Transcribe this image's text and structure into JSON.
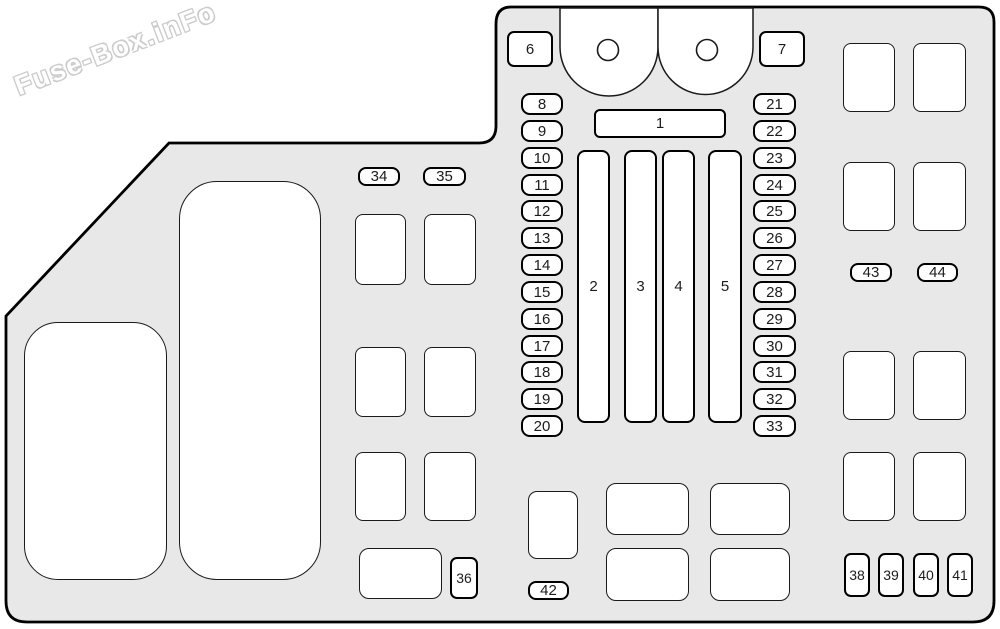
{
  "watermark": {
    "text": "Fuse-Box.inFo"
  },
  "colors": {
    "panel_fill": "#e8e8e8",
    "outline": "#000000",
    "box_fill": "#ffffff",
    "thin_line": "#1a1a1a",
    "label_text": "#1c1c1c"
  },
  "panel": {
    "description": "fuse-box-diagram",
    "numbered_boxes": [
      {
        "label": "6",
        "x": 507,
        "y": 31,
        "w": 46,
        "h": 36,
        "r": 7
      },
      {
        "label": "7",
        "x": 759,
        "y": 31,
        "w": 46,
        "h": 36,
        "r": 7
      },
      {
        "label": "1",
        "x": 594,
        "y": 109,
        "w": 132,
        "h": 29,
        "r": 6
      },
      {
        "label": "2",
        "x": 577,
        "y": 150,
        "w": 33,
        "h": 273,
        "r": 8
      },
      {
        "label": "3",
        "x": 624,
        "y": 150,
        "w": 33,
        "h": 273,
        "r": 8
      },
      {
        "label": "4",
        "x": 662,
        "y": 150,
        "w": 33,
        "h": 273,
        "r": 8
      },
      {
        "label": "5",
        "x": 708,
        "y": 150,
        "w": 34,
        "h": 273,
        "r": 8
      },
      {
        "label": "8",
        "x": 521,
        "y": 93,
        "w": 42,
        "h": 22,
        "r": 9
      },
      {
        "label": "9",
        "x": 521,
        "y": 120,
        "w": 42,
        "h": 22,
        "r": 9
      },
      {
        "label": "10",
        "x": 521,
        "y": 147,
        "w": 42,
        "h": 22,
        "r": 9
      },
      {
        "label": "11",
        "x": 521,
        "y": 174,
        "w": 42,
        "h": 22,
        "r": 9
      },
      {
        "label": "12",
        "x": 521,
        "y": 200,
        "w": 42,
        "h": 22,
        "r": 9
      },
      {
        "label": "13",
        "x": 521,
        "y": 227,
        "w": 42,
        "h": 22,
        "r": 9
      },
      {
        "label": "14",
        "x": 521,
        "y": 254,
        "w": 42,
        "h": 22,
        "r": 9
      },
      {
        "label": "15",
        "x": 521,
        "y": 281,
        "w": 42,
        "h": 22,
        "r": 9
      },
      {
        "label": "16",
        "x": 521,
        "y": 308,
        "w": 42,
        "h": 22,
        "r": 9
      },
      {
        "label": "17",
        "x": 521,
        "y": 335,
        "w": 42,
        "h": 22,
        "r": 9
      },
      {
        "label": "18",
        "x": 521,
        "y": 361,
        "w": 42,
        "h": 22,
        "r": 9
      },
      {
        "label": "19",
        "x": 521,
        "y": 388,
        "w": 42,
        "h": 22,
        "r": 9
      },
      {
        "label": "20",
        "x": 521,
        "y": 415,
        "w": 42,
        "h": 22,
        "r": 9
      },
      {
        "label": "21",
        "x": 753,
        "y": 93,
        "w": 43,
        "h": 22,
        "r": 9
      },
      {
        "label": "22",
        "x": 753,
        "y": 120,
        "w": 43,
        "h": 22,
        "r": 9
      },
      {
        "label": "23",
        "x": 753,
        "y": 147,
        "w": 43,
        "h": 22,
        "r": 9
      },
      {
        "label": "24",
        "x": 753,
        "y": 174,
        "w": 43,
        "h": 22,
        "r": 9
      },
      {
        "label": "25",
        "x": 753,
        "y": 200,
        "w": 43,
        "h": 22,
        "r": 9
      },
      {
        "label": "26",
        "x": 753,
        "y": 227,
        "w": 43,
        "h": 22,
        "r": 9
      },
      {
        "label": "27",
        "x": 753,
        "y": 254,
        "w": 43,
        "h": 22,
        "r": 9
      },
      {
        "label": "28",
        "x": 753,
        "y": 281,
        "w": 43,
        "h": 22,
        "r": 9
      },
      {
        "label": "29",
        "x": 753,
        "y": 308,
        "w": 43,
        "h": 22,
        "r": 9
      },
      {
        "label": "30",
        "x": 753,
        "y": 335,
        "w": 43,
        "h": 22,
        "r": 9
      },
      {
        "label": "31",
        "x": 753,
        "y": 361,
        "w": 43,
        "h": 22,
        "r": 9
      },
      {
        "label": "32",
        "x": 753,
        "y": 388,
        "w": 43,
        "h": 22,
        "r": 9
      },
      {
        "label": "33",
        "x": 753,
        "y": 415,
        "w": 43,
        "h": 22,
        "r": 9
      },
      {
        "label": "34",
        "x": 358,
        "y": 167,
        "w": 42,
        "h": 19,
        "r": 8
      },
      {
        "label": "35",
        "x": 423,
        "y": 167,
        "w": 43,
        "h": 19,
        "r": 8
      },
      {
        "label": "36",
        "x": 450,
        "y": 557,
        "w": 28,
        "h": 42,
        "r": 7,
        "fs": 14
      },
      {
        "label": "38",
        "x": 844,
        "y": 553,
        "w": 26,
        "h": 44,
        "r": 7,
        "fs": 14
      },
      {
        "label": "39",
        "x": 878,
        "y": 553,
        "w": 26,
        "h": 44,
        "r": 7,
        "fs": 14
      },
      {
        "label": "40",
        "x": 913,
        "y": 553,
        "w": 26,
        "h": 44,
        "r": 7,
        "fs": 14
      },
      {
        "label": "41",
        "x": 947,
        "y": 553,
        "w": 26,
        "h": 44,
        "r": 7,
        "fs": 14
      },
      {
        "label": "42",
        "x": 528,
        "y": 581,
        "w": 41,
        "h": 19,
        "r": 8
      },
      {
        "label": "43",
        "x": 850,
        "y": 263,
        "w": 42,
        "h": 19,
        "r": 8
      },
      {
        "label": "44",
        "x": 917,
        "y": 263,
        "w": 41,
        "h": 19,
        "r": 8
      }
    ],
    "plain_boxes": [
      {
        "name": "cover-left",
        "x": 24,
        "y": 322,
        "w": 143,
        "h": 258,
        "r": 34
      },
      {
        "name": "cover-tall",
        "x": 179,
        "y": 181,
        "w": 142,
        "h": 399,
        "r": 38
      },
      {
        "name": "relay-block",
        "x": 355,
        "y": 214,
        "w": 51,
        "h": 71,
        "r": 8
      },
      {
        "name": "relay-block",
        "x": 424,
        "y": 214,
        "w": 52,
        "h": 71,
        "r": 8
      },
      {
        "name": "relay-block",
        "x": 355,
        "y": 347,
        "w": 51,
        "h": 70,
        "r": 8
      },
      {
        "name": "relay-block",
        "x": 424,
        "y": 347,
        "w": 52,
        "h": 70,
        "r": 8
      },
      {
        "name": "relay-block",
        "x": 355,
        "y": 452,
        "w": 51,
        "h": 69,
        "r": 8
      },
      {
        "name": "relay-block",
        "x": 424,
        "y": 452,
        "w": 52,
        "h": 69,
        "r": 8
      },
      {
        "name": "relay-block",
        "x": 359,
        "y": 548,
        "w": 83,
        "h": 51,
        "r": 10
      },
      {
        "name": "relay-block",
        "x": 528,
        "y": 491,
        "w": 50,
        "h": 68,
        "r": 9
      },
      {
        "name": "relay-block",
        "x": 606,
        "y": 483,
        "w": 83,
        "h": 52,
        "r": 10
      },
      {
        "name": "relay-block",
        "x": 710,
        "y": 483,
        "w": 80,
        "h": 52,
        "r": 10
      },
      {
        "name": "relay-block",
        "x": 606,
        "y": 548,
        "w": 83,
        "h": 53,
        "r": 10
      },
      {
        "name": "relay-block",
        "x": 710,
        "y": 548,
        "w": 80,
        "h": 53,
        "r": 10
      },
      {
        "name": "relay-block",
        "x": 843,
        "y": 43,
        "w": 52,
        "h": 69,
        "r": 8
      },
      {
        "name": "relay-block",
        "x": 913,
        "y": 43,
        "w": 53,
        "h": 69,
        "r": 8
      },
      {
        "name": "relay-block",
        "x": 843,
        "y": 162,
        "w": 52,
        "h": 69,
        "r": 8
      },
      {
        "name": "relay-block",
        "x": 913,
        "y": 162,
        "w": 53,
        "h": 69,
        "r": 8
      },
      {
        "name": "relay-block",
        "x": 843,
        "y": 351,
        "w": 52,
        "h": 69,
        "r": 8
      },
      {
        "name": "relay-block",
        "x": 913,
        "y": 351,
        "w": 53,
        "h": 69,
        "r": 8
      },
      {
        "name": "relay-block",
        "x": 843,
        "y": 452,
        "w": 52,
        "h": 69,
        "r": 8
      },
      {
        "name": "relay-block",
        "x": 913,
        "y": 452,
        "w": 53,
        "h": 69,
        "r": 8
      }
    ]
  }
}
